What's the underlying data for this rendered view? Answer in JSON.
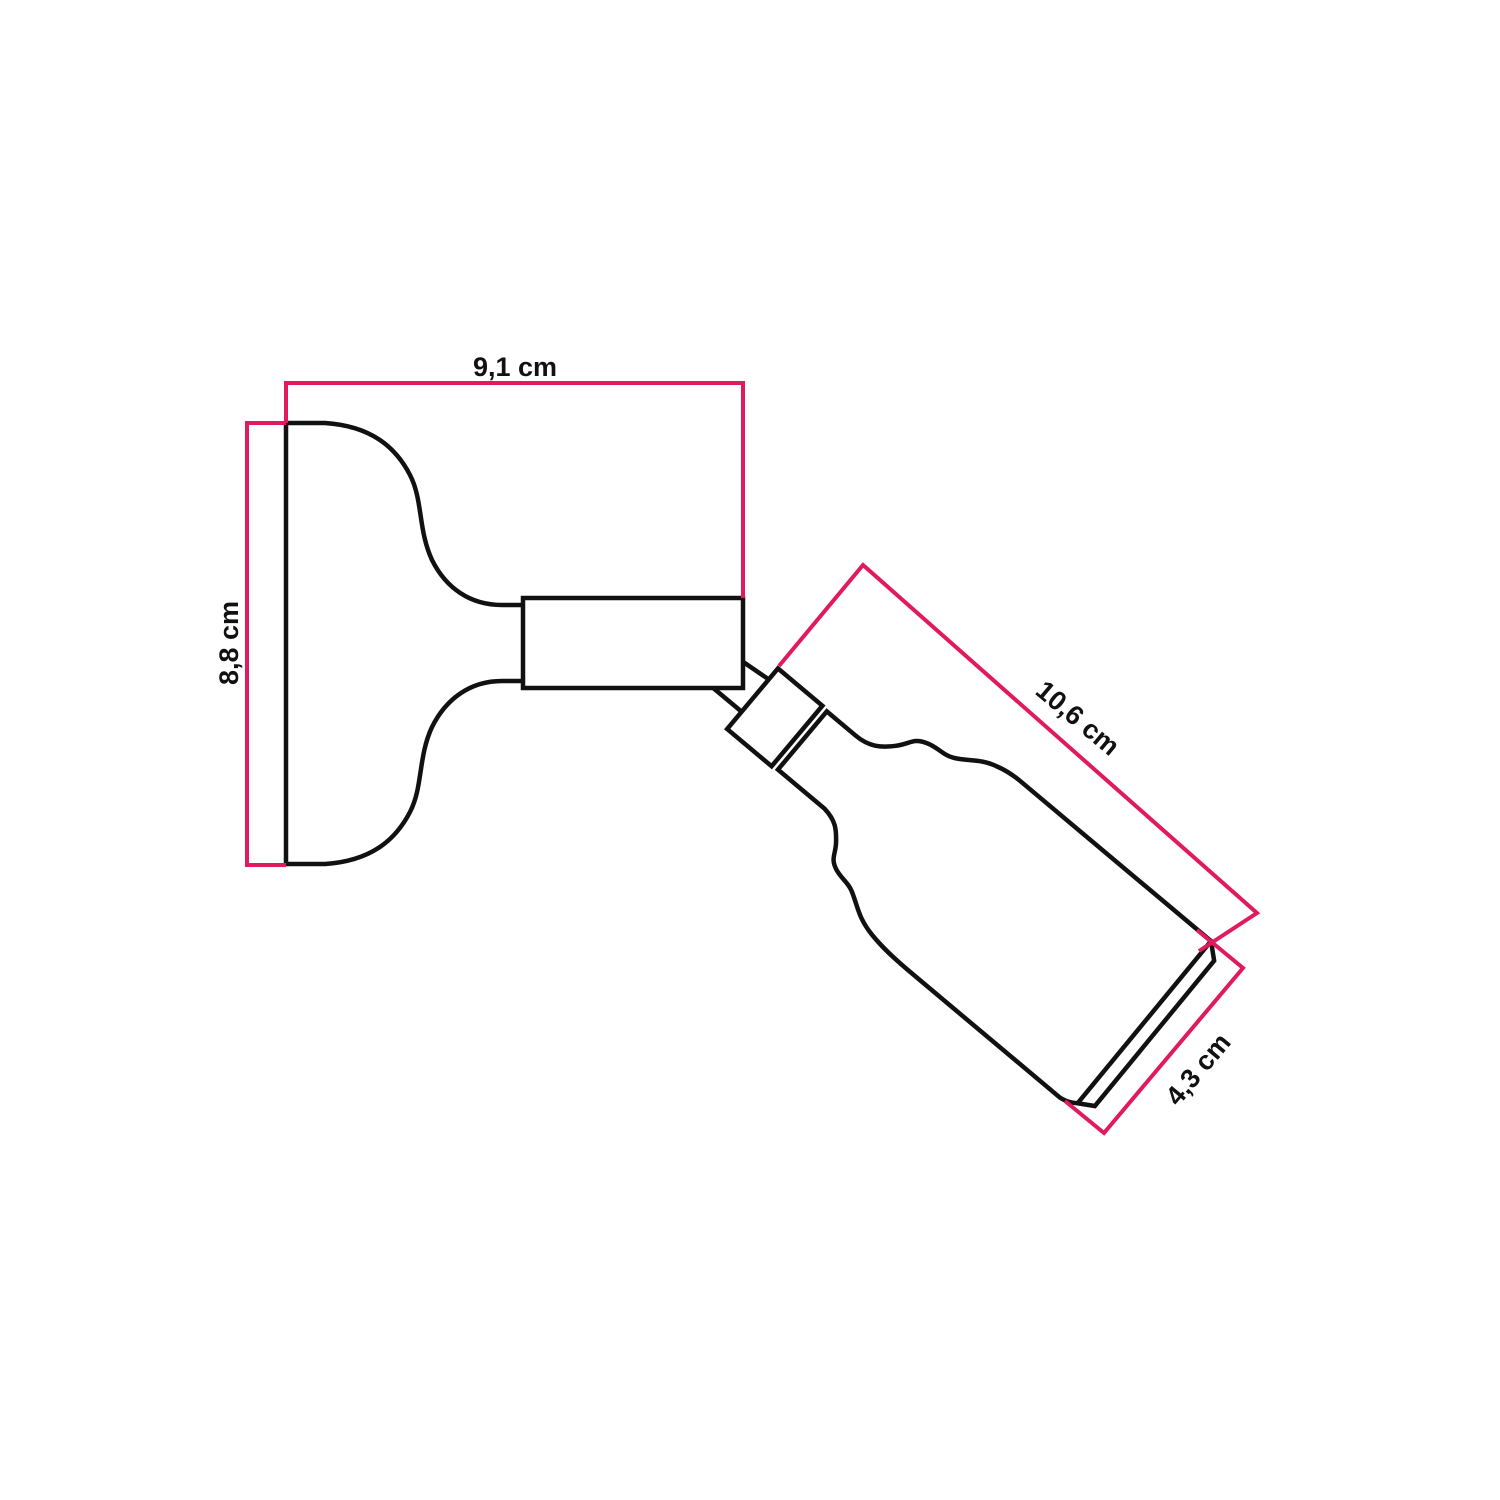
{
  "diagram": {
    "colors": {
      "outline": "#111111",
      "dimension": "#e11a5f",
      "background": "#ffffff"
    },
    "dimensions": {
      "base_width": {
        "label": "9,1 cm"
      },
      "base_height": {
        "label": "8,8 cm"
      },
      "lamp_length": {
        "label": "10,6 cm"
      },
      "lamp_diameter": {
        "label": "4,3 cm"
      }
    }
  }
}
